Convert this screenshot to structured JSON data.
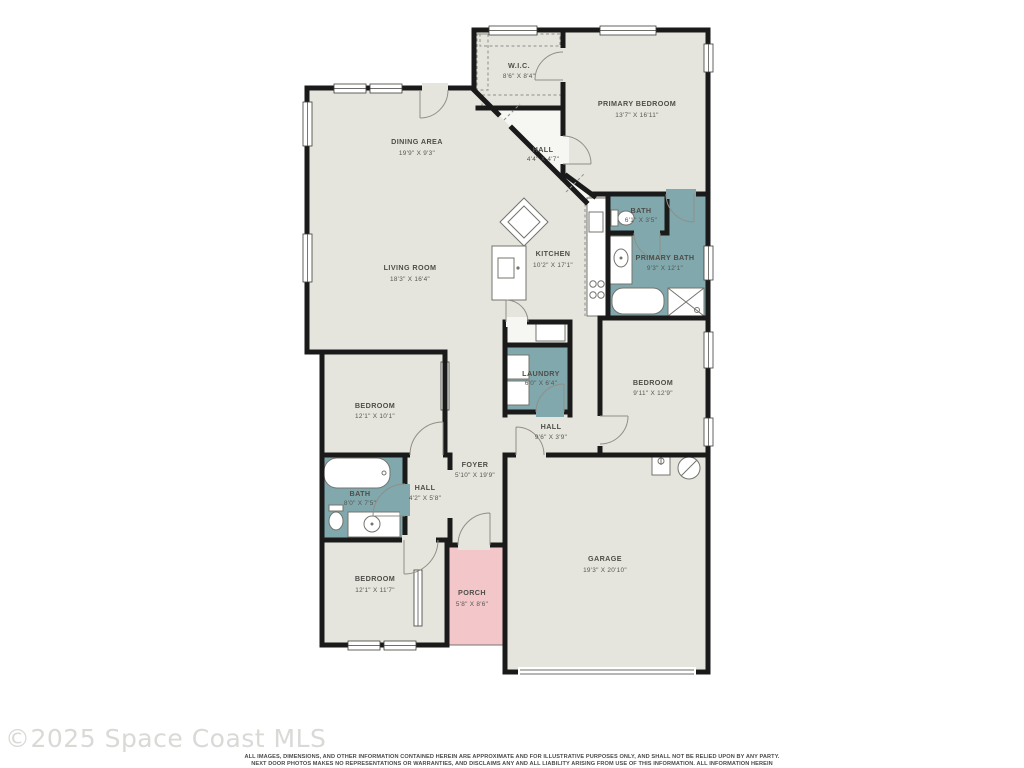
{
  "watermark": "©2025 Space Coast MLS",
  "disclaimer": {
    "line1": "ALL IMAGES, DIMENSIONS, AND OTHER INFORMATION CONTAINED HEREIN ARE APPROXIMATE AND FOR ILLUSTRATIVE PURPOSES ONLY, AND SHALL NOT BE RELIED UPON BY ANY PARTY.",
    "line2": "NEXT DOOR PHOTOS MAKES NO REPRESENTATIONS OR WARRANTIES, AND DISCLAIMS ANY AND ALL LIABILITY ARISING FROM USE OF THIS INFORMATION. ALL INFORMATION HEREIN",
    "line3": "SHALL BE SUBJECT TO THE TERMS AND CONDITIONS FOUND AT NEXTDOORPHOTOS.COMTC."
  },
  "colors": {
    "floor": "#e6e5dd",
    "wet": "#80a8ad",
    "porch": "#f3c7ca",
    "wall": "#1a1a1a",
    "hallfloor": "#f6f6f2"
  },
  "rooms": {
    "wic": {
      "name": "W.I.C.",
      "dims": "8'6\" X 8'4\""
    },
    "primary_bedroom": {
      "name": "PRIMARY BEDROOM",
      "dims": "13'7\" X 16'11\""
    },
    "dining": {
      "name": "DINING AREA",
      "dims": "19'9\" X 9'3\""
    },
    "hall_top": {
      "name": "HALL",
      "dims": "4'4\" X 4'7\""
    },
    "bath_wc": {
      "name": "BATH",
      "dims": "6'1\" X 3'5\""
    },
    "primary_bath": {
      "name": "PRIMARY BATH",
      "dims": "9'3\" X 12'1\""
    },
    "kitchen": {
      "name": "KITCHEN",
      "dims": "10'2\" X 17'1\""
    },
    "living": {
      "name": "LIVING ROOM",
      "dims": "18'3\" X 16'4\""
    },
    "laundry": {
      "name": "LAUNDRY",
      "dims": "6'0\" X 6'4\""
    },
    "bedroom_right": {
      "name": "BEDROOM",
      "dims": "9'11\" X 12'9\""
    },
    "bedroom_mid": {
      "name": "BEDROOM",
      "dims": "12'1\" X 10'1\""
    },
    "hall_mid": {
      "name": "HALL",
      "dims": "9'6\" X 3'9\""
    },
    "foyer": {
      "name": "FOYER",
      "dims": "5'10\" X 19'9\""
    },
    "hall_left": {
      "name": "HALL",
      "dims": "4'2\" X 5'8\""
    },
    "bath_left": {
      "name": "BATH",
      "dims": "8'0\" X 7'5\""
    },
    "bedroom_bottom": {
      "name": "BEDROOM",
      "dims": "12'1\" X 11'7\""
    },
    "porch": {
      "name": "PORCH",
      "dims": "5'8\" X 8'6\""
    },
    "garage": {
      "name": "GARAGE",
      "dims": "19'3\" X 20'10\""
    }
  }
}
